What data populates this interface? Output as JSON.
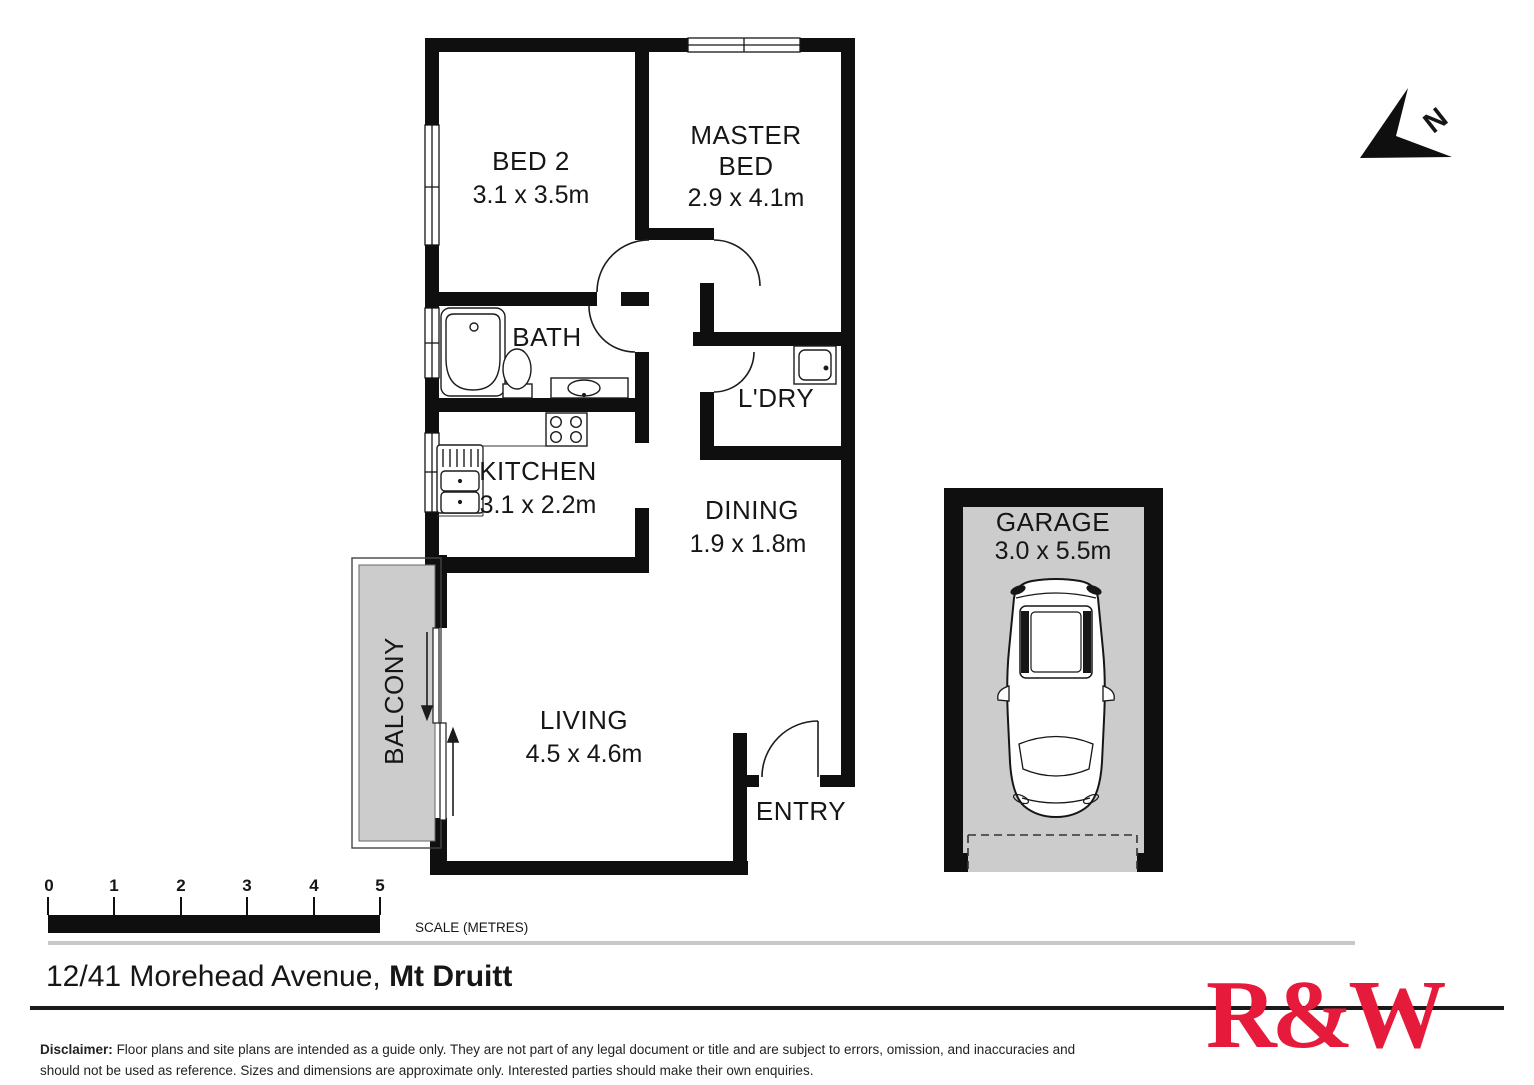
{
  "plan": {
    "bed2": {
      "label": "BED 2",
      "dims": "3.1 x 3.5m"
    },
    "master": {
      "label_line1": "MASTER",
      "label_line2": "BED",
      "dims": "2.9 x 4.1m"
    },
    "bath": {
      "label": "BATH"
    },
    "laundry": {
      "label": "L'DRY"
    },
    "kitchen": {
      "label": "KITCHEN",
      "dims": "3.1 x 2.2m"
    },
    "dining": {
      "label": "DINING",
      "dims": "1.9 x 1.8m"
    },
    "living": {
      "label": "LIVING",
      "dims": "4.5 x 4.6m"
    },
    "balcony": {
      "label": "BALCONY"
    },
    "entry": {
      "label": "ENTRY"
    },
    "garage": {
      "label": "GARAGE",
      "dims": "3.0 x 5.5m"
    }
  },
  "north": {
    "label": "N"
  },
  "scalebar": {
    "ticks": [
      "0",
      "1",
      "2",
      "3",
      "4",
      "5"
    ],
    "caption": "SCALE (METRES)"
  },
  "footer": {
    "address_street": "12/41 Morehead Avenue,",
    "address_suburb": "Mt Druitt",
    "disclaimer_label": "Disclaimer:",
    "disclaimer_text": "Floor plans and site plans are intended as a guide only. They are not part of any legal document or title and are subject to errors, omission, and inaccuracies and should not be used as reference. Sizes and dimensions are approximate only. Interested parties should make their own enquiries.",
    "logo": "R&W"
  },
  "colors": {
    "wall": "#0f0f0f",
    "area_fill": "#cccccc",
    "brand_red": "#E61A3B"
  }
}
